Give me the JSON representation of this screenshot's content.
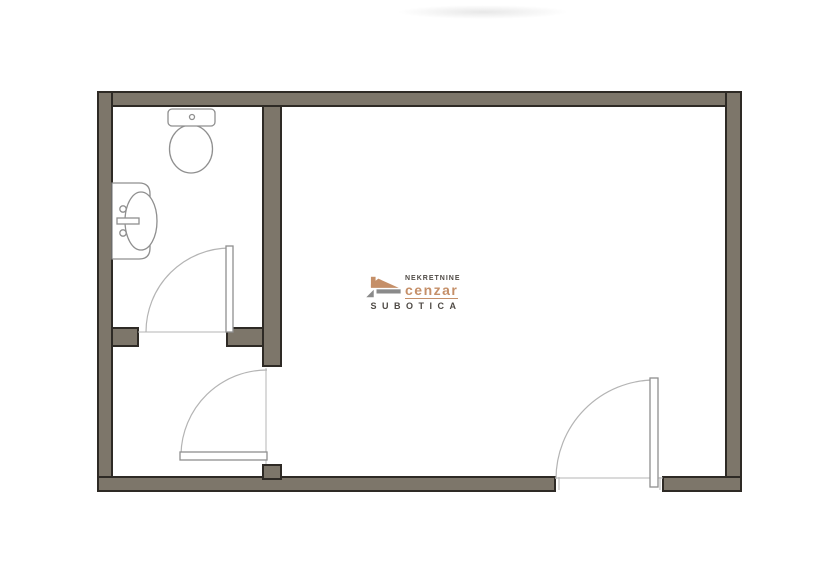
{
  "watermark": {
    "line1": "NEKRETNINE",
    "brand": "cenzar",
    "line2": "SUBOTICA",
    "icon": "house-roof-logo"
  },
  "palette": {
    "wall_fill": "#7d766a",
    "wall_outline": "#2e2a25",
    "fixture_line": "#8f8f8f",
    "door_arc": "#b4b4b4",
    "logo_tan": "#c58f68",
    "logo_text": "#4f4a45",
    "background": "#ffffff"
  },
  "plan": {
    "fixtures": [
      {
        "name": "toilet"
      },
      {
        "name": "washbasin"
      }
    ],
    "doors": [
      {
        "name": "bathroom-door"
      },
      {
        "name": "hallway-door"
      },
      {
        "name": "entry-door"
      }
    ]
  }
}
